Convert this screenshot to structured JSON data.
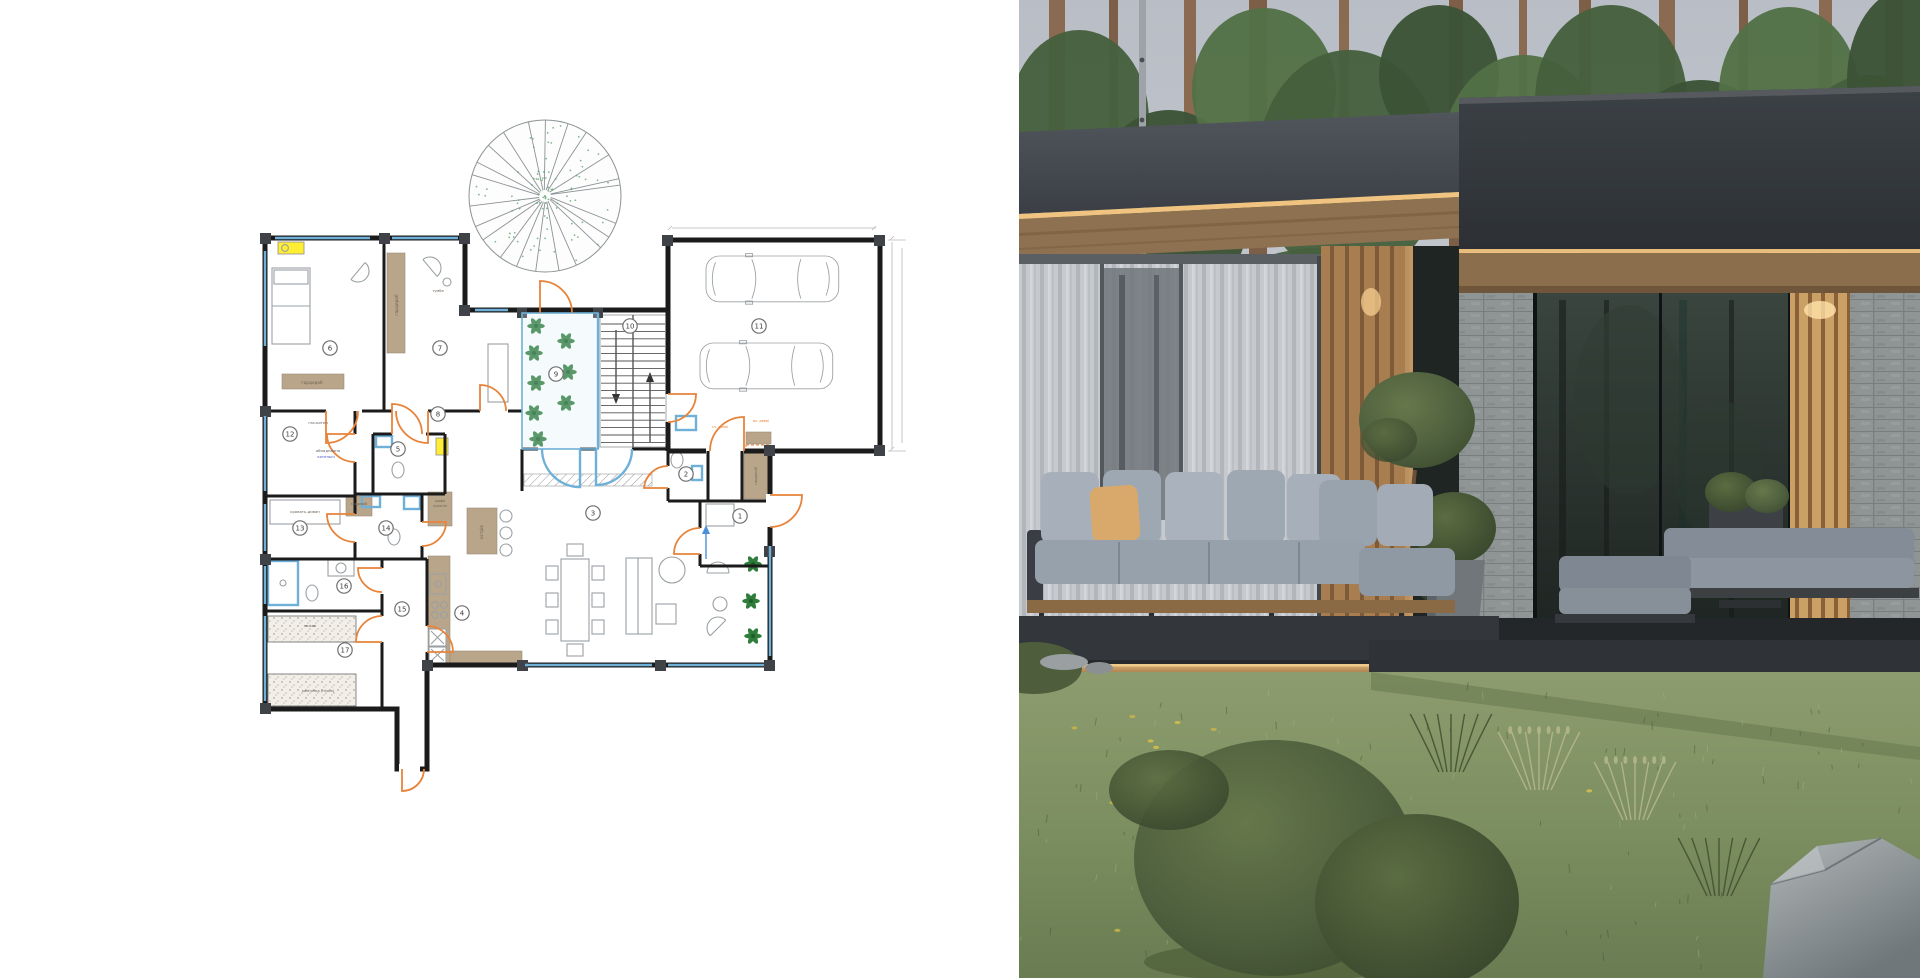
{
  "palette": {
    "wall": "#1b1b1b",
    "furniture": "#9aa0a4",
    "door_orange": "#e8833a",
    "window_blue": "#6fb0d8",
    "wood_tan": "#b9a58a",
    "plant_green": "#2e7d3a",
    "highlight_yellow": "#ffee33",
    "label_blue": "#4a55c8",
    "sky": "#b6bbc2",
    "pine_green": "#46603d",
    "trunk_brown": "#7d5f48",
    "fascia_left": "#464b51",
    "fascia_right": "#33383d",
    "led_warm": "#f2c480",
    "wood_beam": "#8b6e4b",
    "curtain_gray": "#c6c9cd",
    "slat_wood": "#a87e50",
    "slat_lit": "#caa067",
    "brick_gray": "#8f9495",
    "glass_dark": "#232a27",
    "cushion_gray": "#a7b0ba",
    "pillow_tan": "#d9a96c",
    "deck_dark": "#33373b",
    "brass_gold": "#c29457",
    "lawn_green": "#7c8f60",
    "bush_green": "#4e5f3e",
    "rock_gray": "#9ba2a4"
  },
  "floor_plan": {
    "room_markers": [
      {
        "n": "1",
        "x": 500,
        "y": 420
      },
      {
        "n": "2",
        "x": 446,
        "y": 378
      },
      {
        "n": "3",
        "x": 353,
        "y": 417
      },
      {
        "n": "4",
        "x": 222,
        "y": 517
      },
      {
        "n": "5",
        "x": 158,
        "y": 353
      },
      {
        "n": "6",
        "x": 90,
        "y": 252
      },
      {
        "n": "7",
        "x": 200,
        "y": 252
      },
      {
        "n": "8",
        "x": 198,
        "y": 318
      },
      {
        "n": "9",
        "x": 316,
        "y": 278
      },
      {
        "n": "10",
        "x": 390,
        "y": 230
      },
      {
        "n": "11",
        "x": 519,
        "y": 230
      },
      {
        "n": "12",
        "x": 50,
        "y": 338
      },
      {
        "n": "13",
        "x": 60,
        "y": 432
      },
      {
        "n": "14",
        "x": 146,
        "y": 432
      },
      {
        "n": "15",
        "x": 162,
        "y": 513
      },
      {
        "n": "16",
        "x": 104,
        "y": 490
      },
      {
        "n": "17",
        "x": 105,
        "y": 554
      }
    ],
    "labels": [
      {
        "t": "гардероб",
        "x": 158,
        "y": 209,
        "r": -90
      },
      {
        "t": "гардероб",
        "x": 72,
        "y": 288
      },
      {
        "t": "тумба",
        "x": 198,
        "y": 196,
        "s": 3.6
      },
      {
        "t": "газ-котел",
        "x": 78,
        "y": 328,
        "c": "#5a5a5a",
        "s": 3.8
      },
      {
        "t": "обладнання",
        "x": 88,
        "y": 356,
        "c": "#5a5a5a",
        "s": 3.8
      },
      {
        "t": "котельні",
        "x": 86,
        "y": 362,
        "c": "#4a55c8",
        "s": 3.8
      },
      {
        "t": "кровать-диван",
        "x": 65,
        "y": 417,
        "s": 3.8
      },
      {
        "t": "гардероб",
        "x": 119,
        "y": 409,
        "s": 3.3
      },
      {
        "t": "шафи",
        "x": 200,
        "y": 406,
        "s": 3.4
      },
      {
        "t": "кухонні",
        "x": 200,
        "y": 411,
        "s": 3.4
      },
      {
        "t": "острів",
        "x": 243,
        "y": 436,
        "r": -90
      },
      {
        "t": "лежак",
        "x": 70,
        "y": 531,
        "s": 3.8
      },
      {
        "t": "кам'янка (пічка)",
        "x": 78,
        "y": 596,
        "s": 3.8
      },
      {
        "t": "гардероб",
        "x": 517,
        "y": 380,
        "r": -90,
        "s": 3.6
      },
      {
        "t": "сл. двері",
        "x": 480,
        "y": 332,
        "c": "#e8833a",
        "s": 3.6
      },
      {
        "t": "вх. двері",
        "x": 521,
        "y": 326,
        "c": "#e8833a",
        "s": 3.6
      }
    ]
  }
}
